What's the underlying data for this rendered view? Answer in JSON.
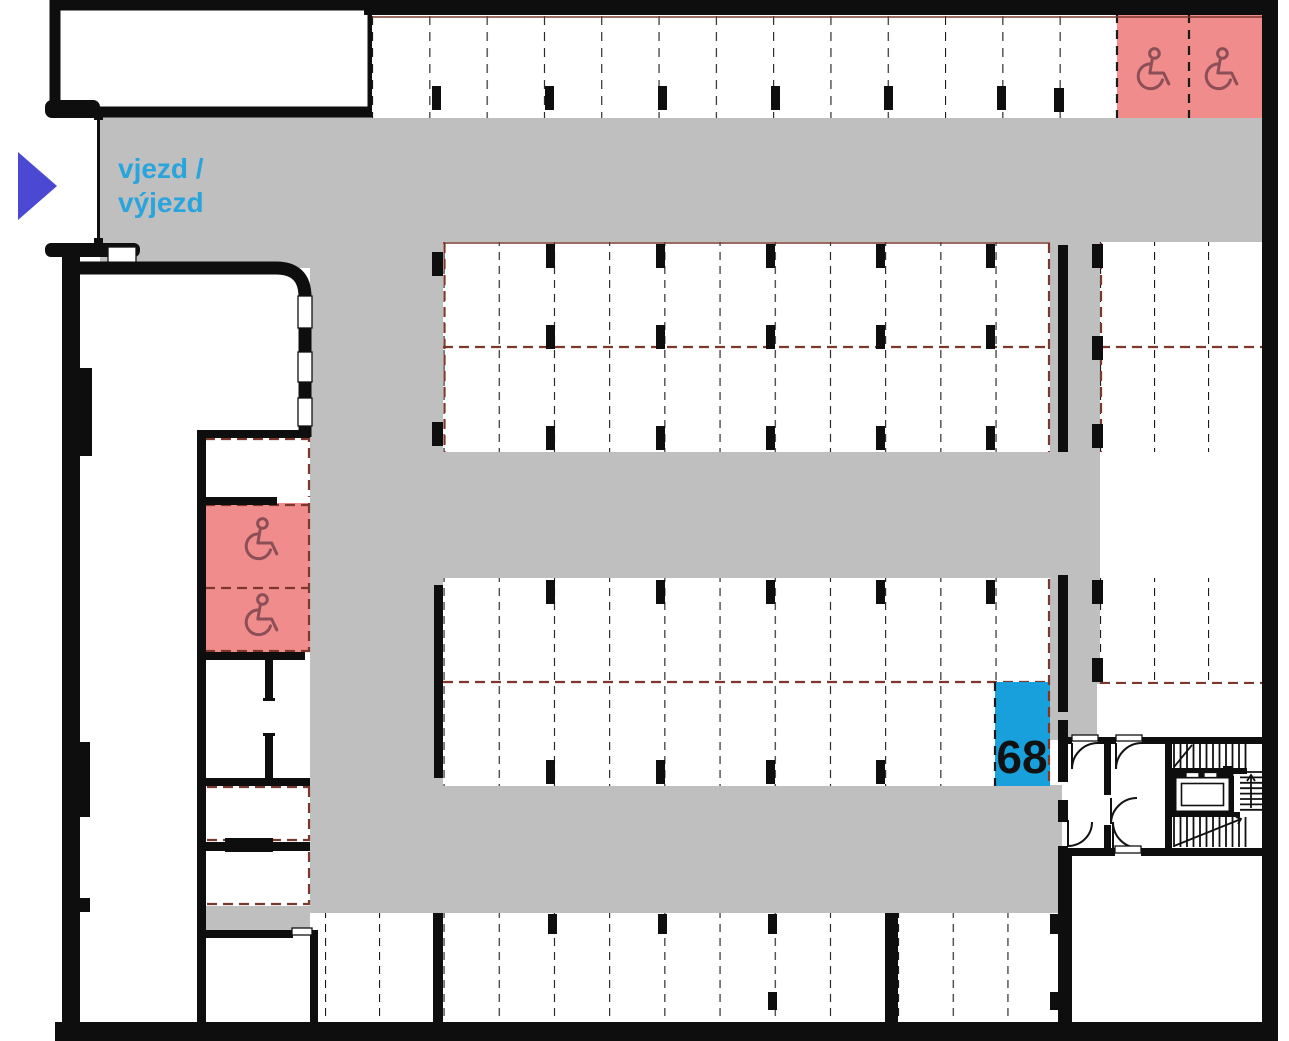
{
  "plan": {
    "title": "parking-garage-floor-plan",
    "entrance": {
      "line1": "vjezd /",
      "line2": "výjezd",
      "arrow_icon": "right-arrow-icon"
    },
    "highlighted_space": {
      "number": "68"
    },
    "accessible": {
      "count": 4,
      "icon": "wheelchair-icon"
    },
    "areas": {
      "top_row_spaces": 13,
      "top_row_accessible": 2,
      "mid_block_a_spaces": 22,
      "right_block_a_spaces": 6,
      "mid_block_b_spaces": 22,
      "right_block_b_spaces": 3,
      "bottom_row_spaces": 13,
      "left_column_spaces": 3,
      "left_column_accessible": 2
    },
    "colors": {
      "wall": "#0e0e0e",
      "road": "#bfbfbf",
      "space": "#ffffff",
      "accessible": "#f18c8c",
      "accessible_icon": "#8c4f57",
      "highlight": "#18a0dd",
      "entrance_text": "#2aa4dc",
      "entrance_arrow": "#4b49d3",
      "divider_black": "#1a1a1a",
      "divider_red": "#7b382b"
    }
  }
}
